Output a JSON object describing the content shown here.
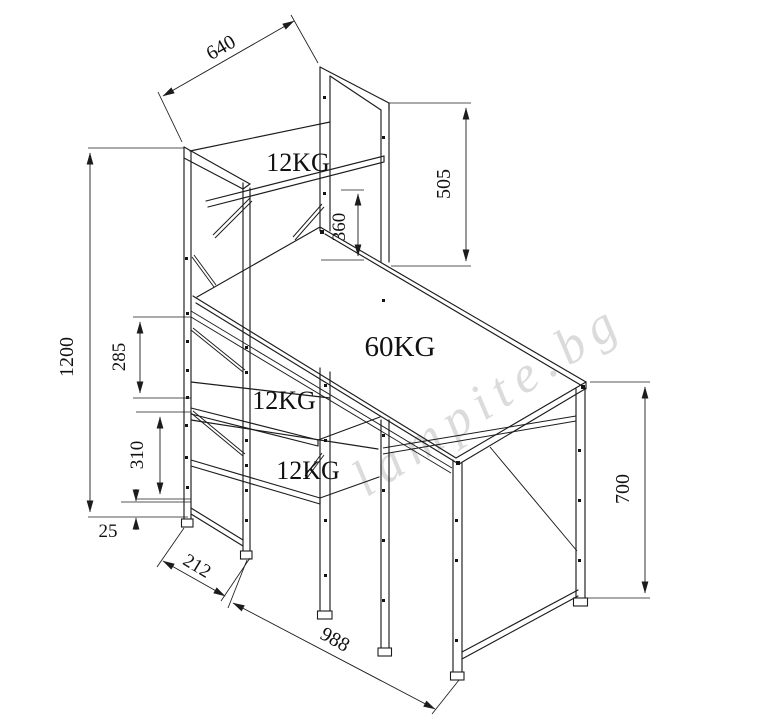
{
  "title": "Desk with integrated shelf - dimensional technical drawing",
  "colors": {
    "line": "#1c1c1c",
    "watermark": "#d8d8d8",
    "background": "#ffffff"
  },
  "watermark": {
    "text": "lampite.bg"
  },
  "labels": {
    "top_shelf": "12KG",
    "desktop": "60KG",
    "middle_shelf": "12KG",
    "bottom_shelf": "12KG"
  },
  "dims": {
    "shelf_width": "640",
    "panel_height_above_desk": "505",
    "desk_to_top_shelf": "360",
    "total_height": "1200",
    "desk_to_middle_shelf": "285",
    "middle_to_bottom_shelf": "310",
    "bottom_clearance": "25",
    "shelf_depth": "212",
    "desk_length": "988",
    "desk_height": "700"
  }
}
